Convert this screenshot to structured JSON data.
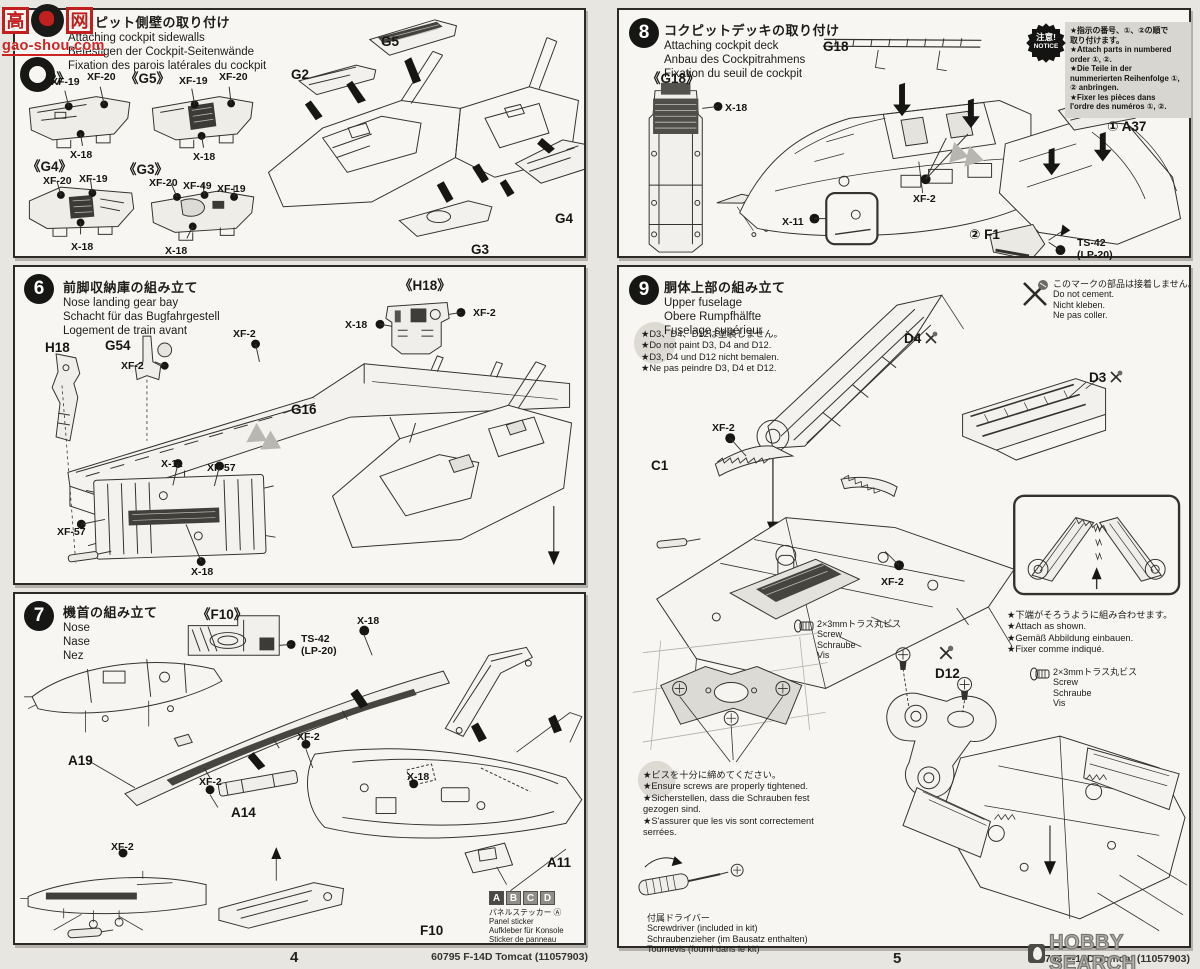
{
  "watermark": {
    "char_left": "高",
    "char_right": "网",
    "site": "gao-shou.com"
  },
  "hobby_search": "HOBBY SEARCH",
  "footer": {
    "kit_code": "60795 F-14D Tomcat (11057903)",
    "page_left": "4",
    "page_right": "5"
  },
  "paints": {
    "xf2": "XF-2",
    "xf19": "XF-19",
    "xf20": "XF-20",
    "xf49": "XF-49",
    "xf57": "XF-57",
    "x11": "X-11",
    "x18": "X-18",
    "ts42": "TS-42",
    "ts42_alt": "(LP-20)"
  },
  "parts": {
    "g2": "G2",
    "g3": "G3",
    "g4": "G4",
    "g5": "G5",
    "g16": "G16",
    "g54": "G54",
    "h18": "H18",
    "a11": "A11",
    "a14": "A14",
    "a19": "A19",
    "f10": "F10",
    "g18": "G18",
    "a37_numbered": "① A37",
    "f1_numbered": "② F1",
    "c1": "C1",
    "d3": "D3",
    "d4": "D4",
    "d12": "D12"
  },
  "insets": {
    "g2": "《G2》",
    "g3": "《G3》",
    "g4": "《G4》",
    "g5": "《G5》",
    "h18": "《H18》",
    "f10": "《F10》",
    "g18": "《G18》"
  },
  "steps": {
    "s5": {
      "ja": "コクピット側壁の取り付け",
      "en": "Attaching cockpit sidewalls",
      "de": "Befestigen der Cockpit-Seitenwände",
      "fr": "Fixation des parois latérales du cockpit"
    },
    "s6": {
      "num": "6",
      "ja": "前脚収納庫の組み立て",
      "en": "Nose landing gear bay",
      "de": "Schacht für das Bugfahrgestell",
      "fr": "Logement de train avant"
    },
    "s7": {
      "num": "7",
      "ja": "機首の組み立て",
      "en": "Nose",
      "de": "Nase",
      "fr": "Nez"
    },
    "s8": {
      "num": "8",
      "ja": "コクピットデッキの取り付け",
      "en": "Attaching cockpit deck",
      "de": "Anbau des Cockpitrahmens",
      "fr": "Fixation du seuil de cockpit"
    },
    "s9": {
      "num": "9",
      "ja": "胴体上部の組み立て",
      "en": "Upper fuselage",
      "de": "Obere Rumpfhälfte",
      "fr": "Fuselage supérieur"
    }
  },
  "notice": {
    "badge_ja": "注意!",
    "badge_en": "NOTICE",
    "lines": [
      "★指示の番号、①、②の順で",
      "取り付けます。",
      "★Attach parts in numbered",
      "order ①, ②.",
      "★Die Teile in der",
      "nummerierten Reihenfolge ①,",
      "② anbringen.",
      "★Fixer les pièces dans",
      "l'ordre des numéros ①, ②."
    ]
  },
  "notes": {
    "do_not_paint": [
      "★D3、D4、D12は塗装しません。",
      "★Do not paint D3, D4 and D12.",
      "★D3, D4 und D12 nicht bemalen.",
      "★Ne pas peindre D3, D4 et D12."
    ],
    "do_not_cement": [
      "このマークの部品は接着しません。",
      "Do not cement.",
      "Nicht kleben.",
      "Ne pas coller."
    ],
    "attach_shown": [
      "★下端がそろうように組み合わせます。",
      "★Attach as shown.",
      "★Gemäß Abbildung einbauen.",
      "★Fixer comme indiqué."
    ],
    "tighten": [
      "★ビスを十分に締めてください。",
      "★Ensure screws are properly tightened.",
      "★Sicherstellen, dass die Schrauben fest",
      "gezogen sind.",
      "★S'assurer que les vis sont correctement",
      "serrées."
    ],
    "screw": [
      "2×3mmトラス丸ビス",
      "Screw",
      "Schraube",
      "Vis"
    ],
    "screwdriver": [
      "付属ドライバー",
      "Screwdriver (included in kit)",
      "Schraubenzieher (im Bausatz enthalten)",
      "Tournevis (fourni dans le kit)"
    ],
    "panel_sticker": [
      "パネルステッカー Ⓐ",
      "Panel sticker",
      "Aufkleber für Konsole",
      "Sticker de panneau"
    ],
    "sticker_letters": [
      "A",
      "B",
      "C",
      "D"
    ]
  }
}
